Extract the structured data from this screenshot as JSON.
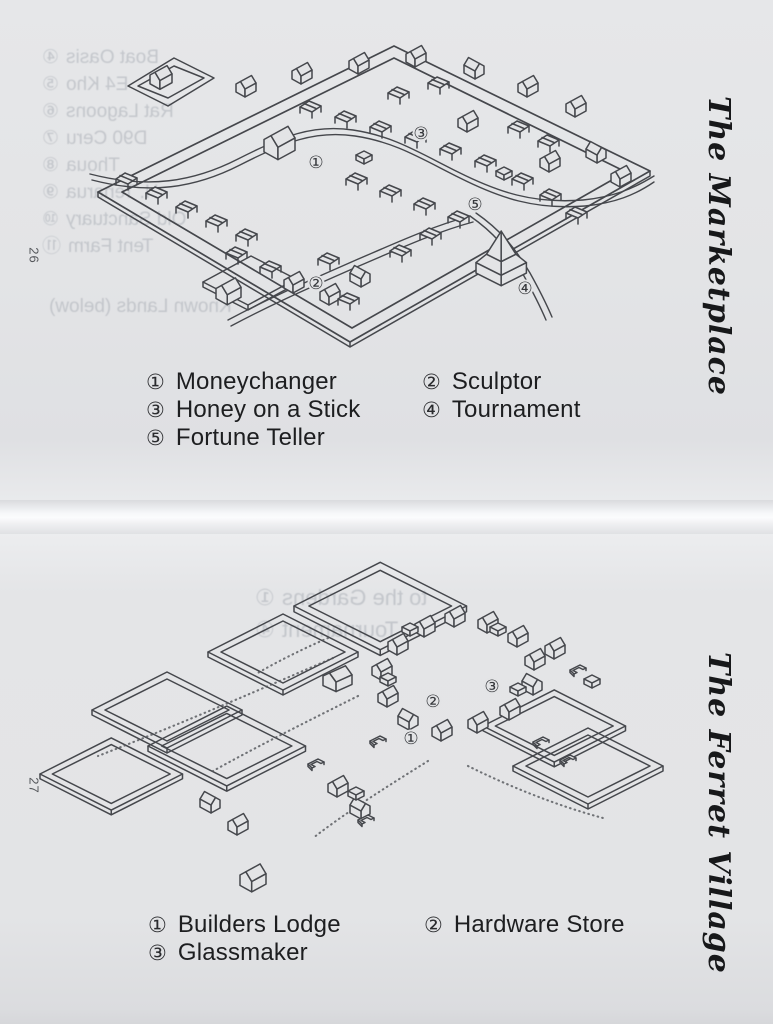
{
  "scan": {
    "pages": [
      {
        "page_number": "26",
        "side_title": "The Marketplace",
        "legend": [
          {
            "num": "①",
            "label": "Moneychanger"
          },
          {
            "num": "②",
            "label": "Sculptor"
          },
          {
            "num": "③",
            "label": "Honey on a Stick"
          },
          {
            "num": "④",
            "label": "Tournament"
          },
          {
            "num": "⑤",
            "label": "Fortune Teller"
          }
        ],
        "markers": [
          "①",
          "②",
          "③",
          "④",
          "⑤"
        ],
        "bleedthrough": [
          {
            "num": "④",
            "text": "Boat Oasis"
          },
          {
            "num": "⑤",
            "text": "E4 Kho"
          },
          {
            "num": "⑥",
            "text": "Rat Lagoons"
          },
          {
            "num": "⑦",
            "text": "D90 Ceru"
          },
          {
            "num": "⑧",
            "text": "Thoua"
          },
          {
            "num": "⑨",
            "text": "H. Tenarua"
          },
          {
            "num": "⑩",
            "text": "Old Sanctuary"
          },
          {
            "num": "⑪",
            "text": "Tent Farm"
          },
          {
            "num": "",
            "text": "Known Lands (below)"
          }
        ]
      },
      {
        "page_number": "27",
        "side_title": "The Ferret Village",
        "legend": [
          {
            "num": "①",
            "label": "Builders Lodge"
          },
          {
            "num": "②",
            "label": "Hardware Store"
          },
          {
            "num": "③",
            "label": "Glassmaker"
          }
        ],
        "markers": [
          "①",
          "②",
          "③"
        ],
        "bleedthrough": [
          {
            "num": "①",
            "text": "to the Gardens"
          },
          {
            "num": "④",
            "text": "Tournament"
          }
        ]
      }
    ],
    "colors": {
      "paper": "#e3e4e6",
      "ink": "#45474c",
      "text": "#1d1e20"
    }
  }
}
